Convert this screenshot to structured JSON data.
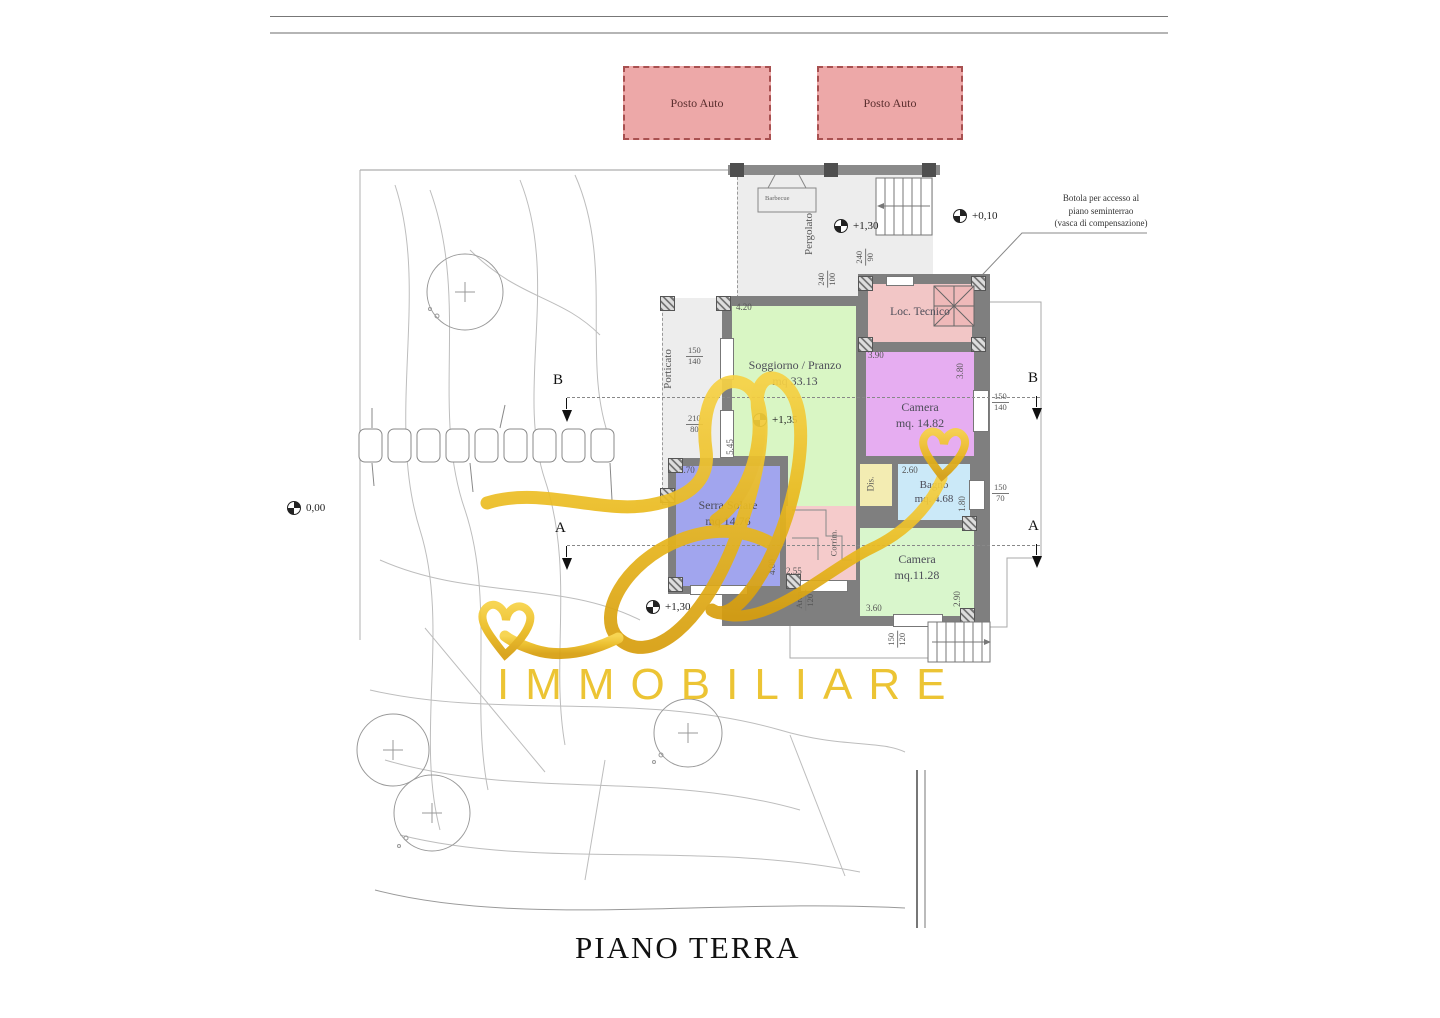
{
  "title": "PIANO TERRA",
  "brand": "IMMOBILIARE",
  "parking": {
    "label": "Posto Auto"
  },
  "note": {
    "line1": "Botola per accesso al",
    "line2": "piano seminterrao",
    "line3": "(vasca di compensazione)"
  },
  "levels": {
    "pergolato_terrace": "+0,10",
    "pergolato": "+1,30",
    "soggiorno": "+1,35",
    "garden": "+1,30",
    "ground": "0,00"
  },
  "sections": {
    "b": "B",
    "a": "A"
  },
  "rooms": {
    "pergolato": {
      "label": "Pergolato"
    },
    "porticato": {
      "label": "Porticato"
    },
    "barbecue": {
      "label": "Barbecue"
    },
    "loc_tecnico": {
      "label": "Loc. Tecnico"
    },
    "soggiorno": {
      "name": "Soggiorno / Pranzo",
      "area": "mq 33.13"
    },
    "camera1": {
      "name": "Camera",
      "area": "mq. 14.82"
    },
    "bagno": {
      "name": "Bagno",
      "area": "mq. 4.68"
    },
    "dis": {
      "label": "Dis."
    },
    "serra": {
      "name": "Serra Solare",
      "area": "mq 14.76"
    },
    "ingresso": {
      "label": "Corrim."
    },
    "camera2": {
      "name": "Camera",
      "area": "mq.11.28"
    }
  },
  "dims": {
    "d420": "4.20",
    "d390": "3.90",
    "d380": "3.80",
    "d260": "2.60",
    "d570": "5.70",
    "d400": "4.00",
    "d255": "2.55",
    "d360": "3.60",
    "d290": "2.90",
    "d180": "1.80",
    "d545": "5.45",
    "w240_90": {
      "a": "240",
      "b": "90"
    },
    "w240_100": {
      "a": "240",
      "b": "100"
    },
    "w150_140_port": {
      "a": "150",
      "b": "140"
    },
    "door210_80": {
      "a": "210",
      "b": "80"
    },
    "w150_140": {
      "a": "150",
      "b": "140"
    },
    "w150_70": {
      "a": "150",
      "b": "70"
    },
    "w150_120": {
      "a": "150",
      "b": "120"
    },
    "arco": {
      "a": "Arco",
      "b": "120"
    }
  },
  "colors": {
    "parking": "#eda8a8",
    "loc_tecnico": "#f2c6c6",
    "camera": "#e6adf1",
    "soggiorno": "#d9f6c4",
    "bagno": "#cbe9f8",
    "serra": "#a1a5ee",
    "ingresso": "#f5cbcb",
    "dis": "#f3ecb2",
    "gold": "#ecc12a"
  }
}
